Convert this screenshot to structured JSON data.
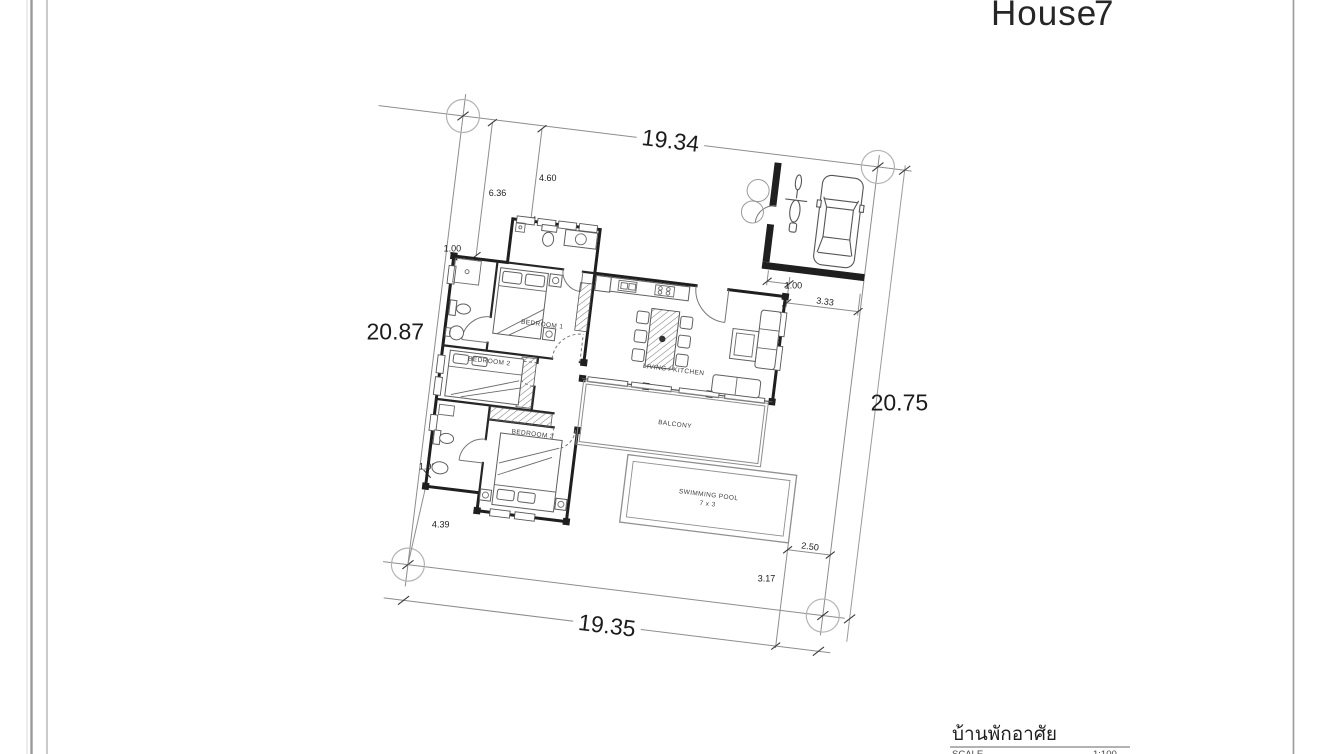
{
  "sheet": {
    "title_word": "House",
    "title_number": "7",
    "title_block": {
      "project_name": "บ้านพักอาศัย",
      "scale_label": "SCALE",
      "scale_value": "1:100"
    }
  },
  "plan": {
    "rooms": {
      "bedroom1": "BEDROOM 1",
      "bedroom2": "BEDROOM 2",
      "bedroom3": "BEDROOM 3",
      "living": "LIVING / KITCHEN",
      "balcony": "BALCONY",
      "pool_line1": "SWIMMING POOL",
      "pool_line2": "7 x 3"
    },
    "dims": {
      "site_top": "19.34",
      "site_left": "20.87",
      "site_right": "20.75",
      "site_bottom": "19.35",
      "setback_nw": "6.36",
      "bath_top": "4.60",
      "wall_nw": "1.00",
      "carport_gate": "1.00",
      "carport_width": "3.33",
      "bath_sw": "1.00",
      "setback_sw": "4.39",
      "pool_east": "2.50",
      "pool_south": "3.17"
    }
  }
}
